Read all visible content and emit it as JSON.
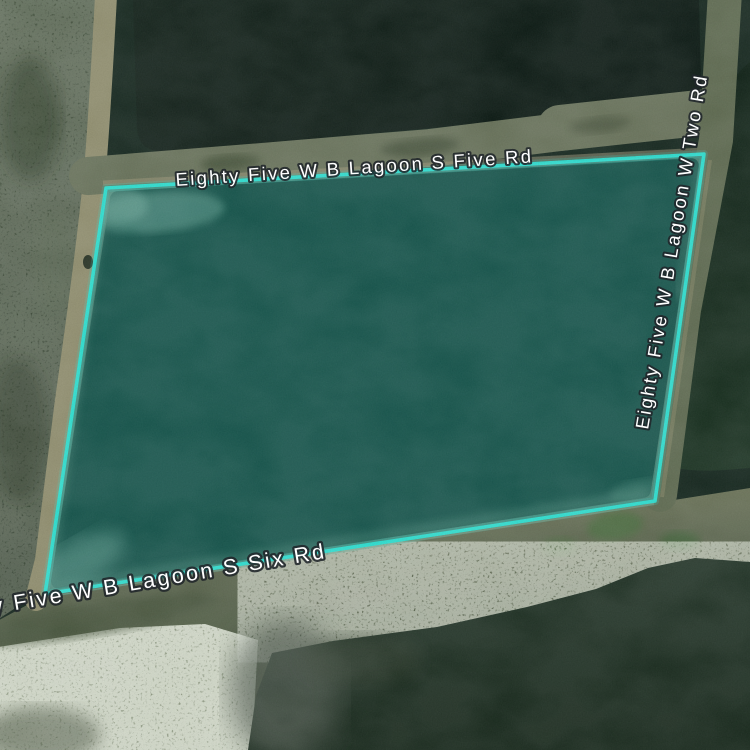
{
  "map": {
    "kind": "satellite-map-tile",
    "roads": {
      "top_label": "Eighty Five W B Lagoon S Five Rd",
      "right_label": "Eighty Five W B Lagoon W Two Rd",
      "bottom_label": "Eighty Five W B Lagoon S Six Rd"
    },
    "selection": {
      "points": "106,188 704,154 655,501 45,594",
      "stroke_color": "#2BE3D4",
      "fill_color": "#2BE3D4",
      "fill_opacity": "0.26"
    },
    "colors": {
      "water_top_cell": "#0D1C16",
      "water_right_cell": "#17301F",
      "water_bottom_cell": "#17291E",
      "lagoon_selected_result": "#0F4F48",
      "berm_road": "#5F6B54",
      "sand_berm": "#8F8C6B",
      "speckled_shore": "#8C977F",
      "label_text": "#FFFFFF",
      "label_halo": "#20262A"
    }
  }
}
